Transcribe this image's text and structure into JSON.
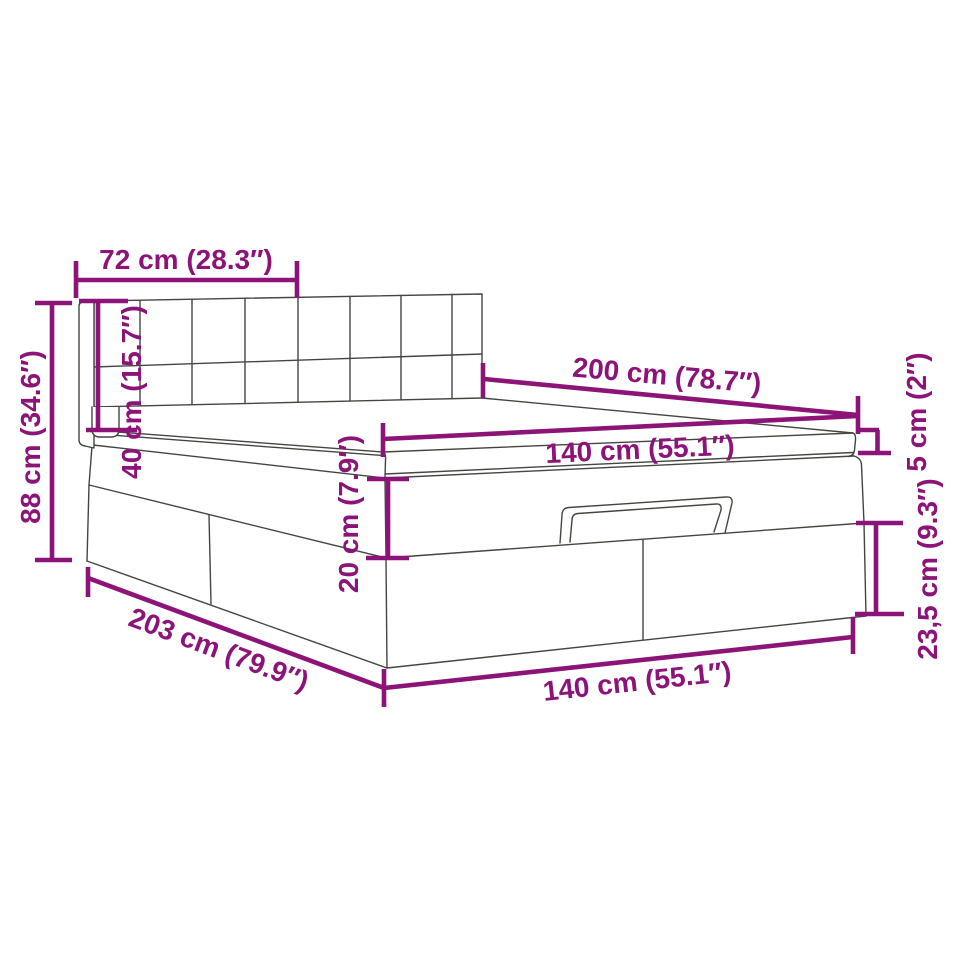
{
  "diagram": {
    "colors": {
      "dimension_accent": "#8C1478",
      "drawing_outline": "#454540",
      "background": "#FFFFFF"
    },
    "labels": {
      "headboard_width": "72 cm (28.3″)",
      "overall_height": "88 cm (34.6″)",
      "headboard_height": "40 cm (15.7″)",
      "length_top": "200 cm (78.7″)",
      "width_top": "140 cm (55.1″)",
      "mattress_thickness": "5 cm (2″)",
      "lid_height": "20 cm (7.9″)",
      "base_height": "23,5 cm (9.3″)",
      "length_overall": "203 cm (79.9″)",
      "width_bottom": "140 cm (55.1″)"
    }
  }
}
